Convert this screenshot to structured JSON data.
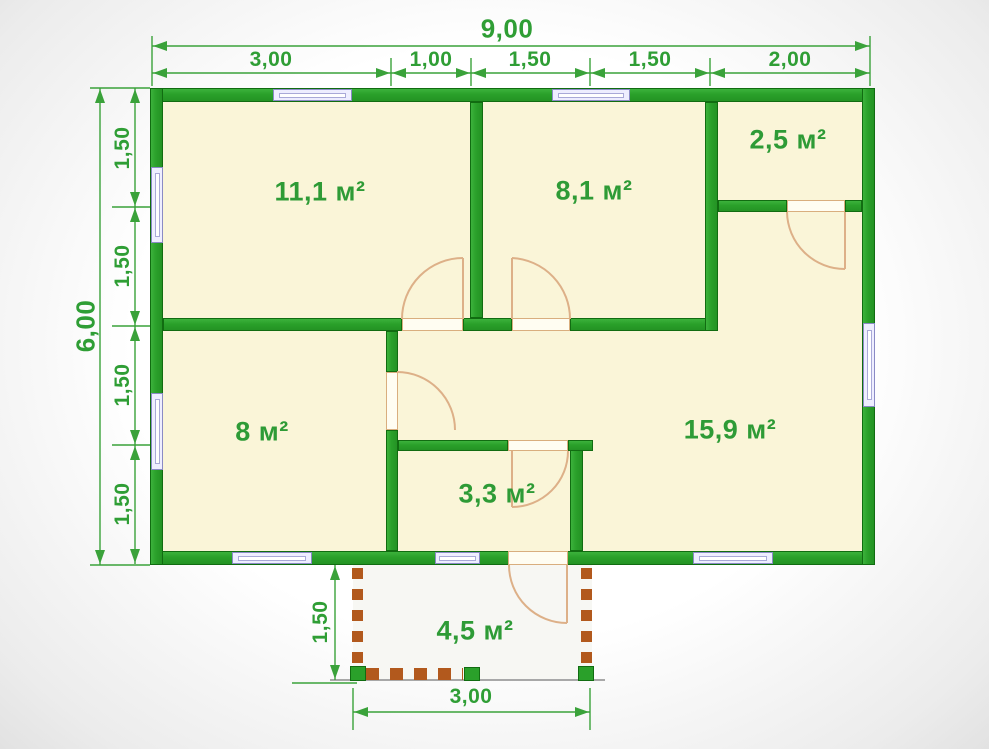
{
  "plan": {
    "title": "house floor plan 9x6",
    "rooms": [
      {
        "id": "room-top-left",
        "label": "11,1 м²"
      },
      {
        "id": "room-top-middle",
        "label": "8,1 м²"
      },
      {
        "id": "room-top-right",
        "label": "2,5 м²"
      },
      {
        "id": "room-bottom-left",
        "label": "8 м²"
      },
      {
        "id": "room-living",
        "label": "15,9 м²"
      },
      {
        "id": "room-small",
        "label": "3,3 м²"
      },
      {
        "id": "porch",
        "label": "4,5 м²"
      }
    ],
    "dimensions": {
      "total_width": "9,00",
      "total_height": "6,00",
      "top_segments": [
        "3,00",
        "1,00",
        "1,50",
        "1,50",
        "2,00"
      ],
      "left_segments": [
        "1,50",
        "1,50",
        "1,50",
        "1,50"
      ],
      "porch_width": "3,00",
      "porch_depth": "1,50"
    },
    "colors": {
      "wall_green": "#2aa02a",
      "dimension_green": "#2f9e35",
      "room_fill": "#faf5d8",
      "door_tan": "#d9ae7e",
      "window_lavender": "#8a8ac5",
      "porch_brick": "#b2591d"
    }
  }
}
